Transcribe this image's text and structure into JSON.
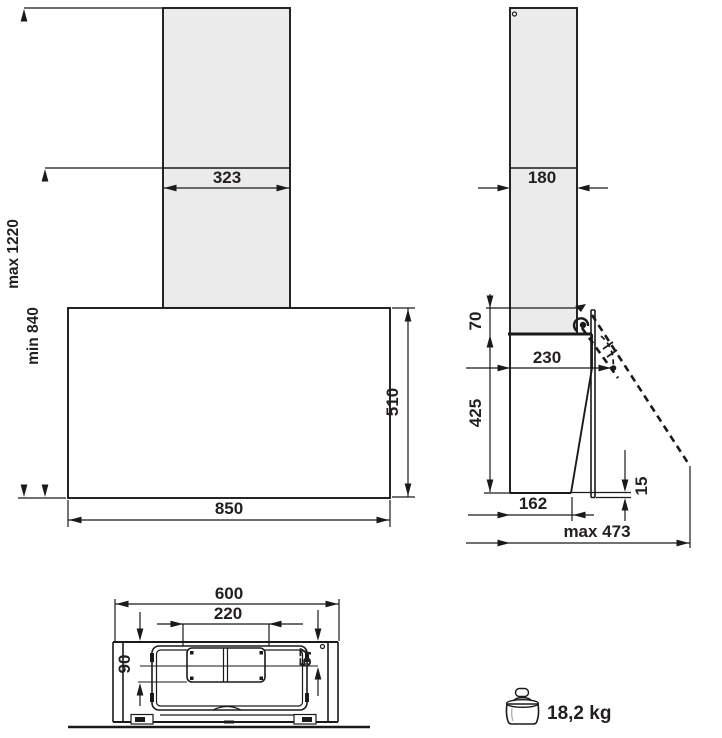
{
  "diagram_title": "cooker-hood-installation-dimensions",
  "front_view": {
    "chimney_width": "323",
    "hood_width": "850",
    "hood_height": "510",
    "mount_height_max": "max 1220",
    "mount_height_min": "min 840"
  },
  "side_view": {
    "chimney_depth": "180",
    "top_overlap": "70",
    "body_height": "425",
    "hinge_depth": "230",
    "bottom_depth": "162",
    "panel_bottom_offset": "15",
    "open_depth_max": "max 473"
  },
  "bottom_view": {
    "body_width": "600",
    "duct_width": "220",
    "duct_rear_offset": "90",
    "duct_center_offset": "57"
  },
  "weight": {
    "value": "18,2 kg"
  },
  "colors": {
    "line": "#1a1a1a",
    "chimney_fill": "#ebebeb",
    "text": "#231f20"
  }
}
